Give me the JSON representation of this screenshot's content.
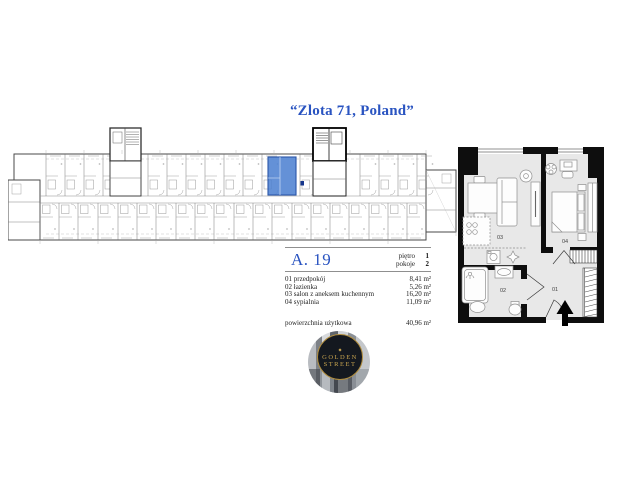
{
  "title": "“Zlota 71, Poland”",
  "unit_info": {
    "code": "A. 19",
    "floor_label": "piętro",
    "floor_value": "1",
    "rooms_label": "pokoje",
    "rooms_value": "2",
    "rooms": [
      {
        "no": "01",
        "name": "przedpokój",
        "area": "8,41 m²"
      },
      {
        "no": "02",
        "name": "łazienka",
        "area": "5,26 m²"
      },
      {
        "no": "03",
        "name": "salon z aneksem kuchennym",
        "area": "16,20 m²"
      },
      {
        "no": "04",
        "name": "sypialnia",
        "area": "11,09 m²"
      }
    ],
    "total_label": "powierzchnia użytkowa",
    "total_value": "40,96 m²"
  },
  "logo": {
    "ornament": "◆",
    "name_line1": "GOLDEN",
    "name_line2": "STREET"
  },
  "apartment_plan": {
    "labels": {
      "hall": "01",
      "bath": "02",
      "living": "03",
      "bedroom": "04"
    }
  },
  "colors": {
    "accent_blue": "#2a54c1",
    "unit_highlight": "#4f82d2",
    "logo_gold": "#c8a44f",
    "logo_bg": "#14181f"
  }
}
